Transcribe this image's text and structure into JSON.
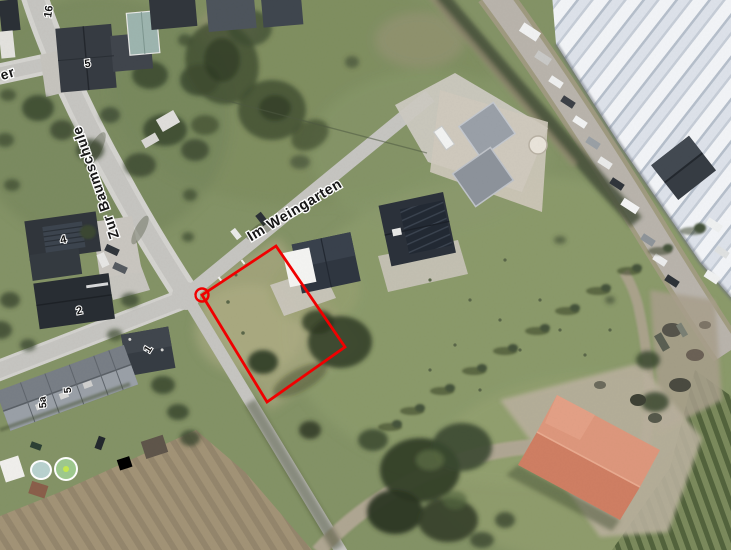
{
  "map": {
    "type": "aerial-orthophoto-with-cadastral-overlay",
    "labels": {
      "streets": [
        {
          "text": "Im Weingarten"
        },
        {
          "text": "Zur Baumschule"
        },
        {
          "text": "er"
        }
      ],
      "house_numbers": [
        {
          "text": "16"
        },
        {
          "text": "5"
        },
        {
          "text": "4"
        },
        {
          "text": "2"
        },
        {
          "text": "1"
        },
        {
          "text": "5a"
        },
        {
          "text": "5"
        }
      ]
    },
    "overlay": {
      "parcel_marked": true,
      "marker_shape": "quadrilateral with corner circle"
    },
    "colors": {
      "parcel_outline": "#f20000",
      "grass": "#849366",
      "road": "#c6c5c1",
      "barn_roof": "#cf7e63",
      "warehouse_roof": "#e8ebf0",
      "label_text": "#161616",
      "label_halo": "#ffffff"
    }
  }
}
